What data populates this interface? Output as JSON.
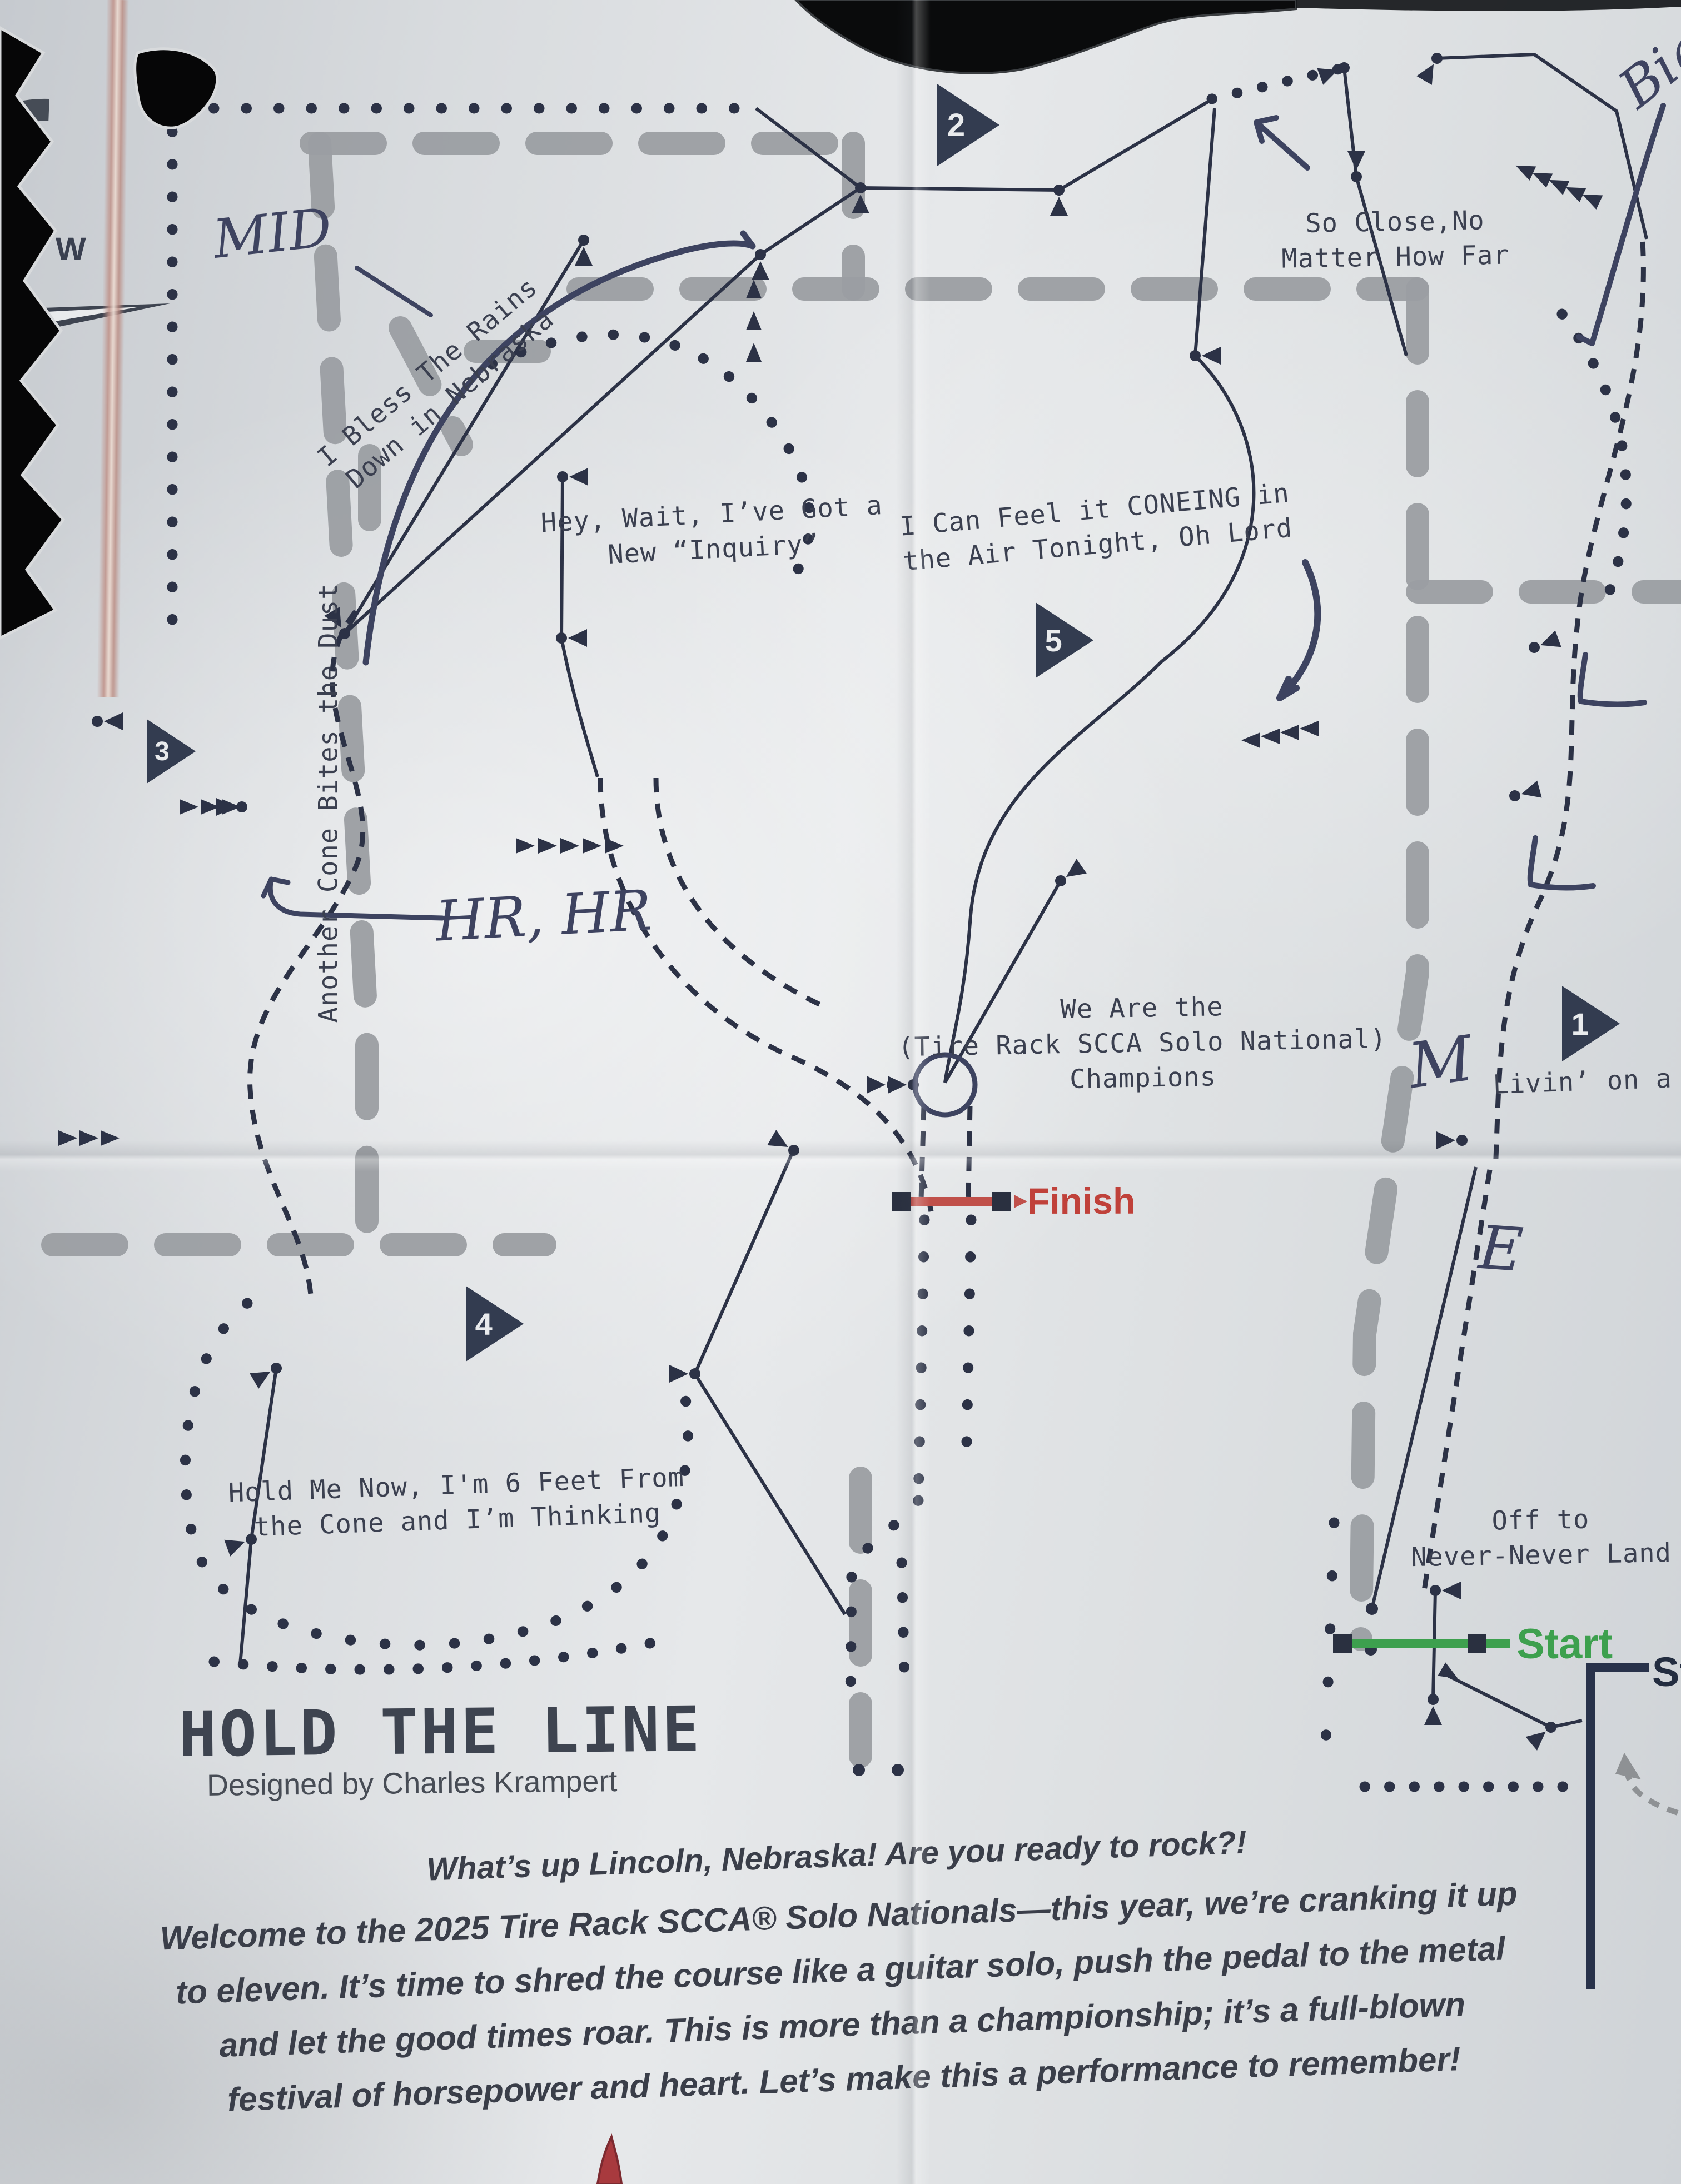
{
  "map": {
    "title": "HOLD THE LINE",
    "byline": "Designed by Charles Krampert",
    "compass": {
      "west": "W"
    },
    "checkpoints": {
      "c1": "1",
      "c2": "2",
      "c3": "3",
      "c4": "4",
      "c5": "5"
    },
    "finish_label": "Finish",
    "start_label": "Start",
    "staging_label": "Staging",
    "labels": {
      "rains_1": "I Bless The Rains",
      "rains_2": "Down in Nebraska",
      "so_close_1": "So Close,No",
      "so_close_2": "Matter How Far",
      "hey_wait_1": "Hey, Wait, I’ve Got a",
      "hey_wait_2": "New “Inquiry”",
      "coneing_1": "I Can Feel it CONEING in",
      "coneing_2": "the Air Tonight, Oh Lord",
      "another_cone": "Another Cone Bites the Dust",
      "we_are_1": "We Are the",
      "we_are_2": "(Tire Rack SCCA Solo National)",
      "we_are_3": "Champions",
      "livin": "Livin’ on a Pray",
      "hold_me_1": "Hold Me Now, I'm 6 Feet From",
      "hold_me_2": "the Cone and I’m Thinking",
      "off_to_1": "Off to",
      "off_to_2": "Never-Never Land"
    },
    "handwritten": {
      "mid": "MID",
      "big": "Big",
      "hr": "HR, HR",
      "m": "M",
      "e": "E"
    }
  },
  "intro": {
    "headline": "What’s up Lincoln, Nebraska! Are you ready to rock?!",
    "line1": "Welcome to the 2025 Tire Rack SCCA® Solo Nationals—this year, we’re cranking it up",
    "line2": "to eleven. It’s time to shred the course like a guitar solo, push the pedal to the metal",
    "line3": "and let the good times roar. This is more than a championship; it’s a full-blown",
    "line4": "festival of horsepower and heart. Let’s make this a performance to remember!"
  },
  "colors": {
    "finish": "#c0413a",
    "start": "#3da04e",
    "staging": "#232d40",
    "ink": "#3b4050",
    "pen": "#3d4360",
    "pavement_gray": "#9b9ea2"
  }
}
